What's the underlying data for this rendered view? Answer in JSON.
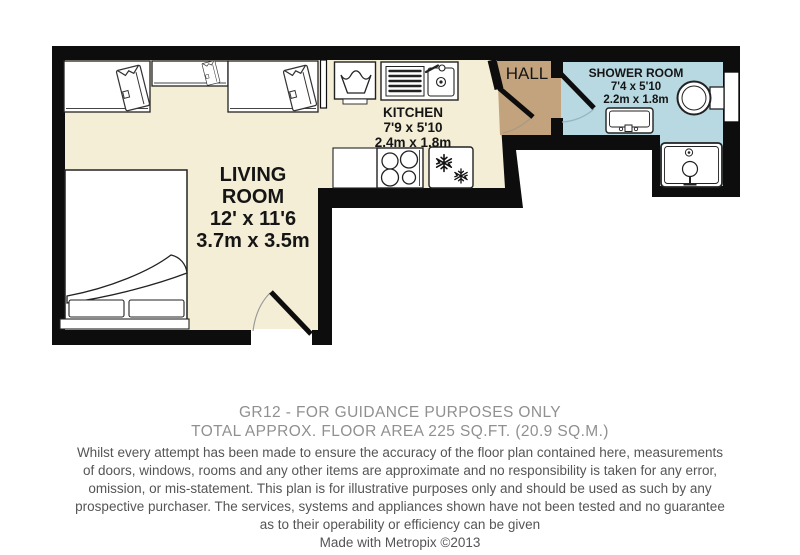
{
  "floorplan": {
    "living_room": {
      "label_line1": "LIVING",
      "label_line2": "ROOM",
      "size_imperial": "12' x 11'6",
      "size_metric": "3.7m x 3.5m"
    },
    "kitchen": {
      "label": "KITCHEN",
      "size_imperial": "7'9 x 5'10",
      "size_metric": "2.4m x 1.8m"
    },
    "hall": {
      "label": "HALL"
    },
    "shower_room": {
      "label": "SHOWER ROOM",
      "size_imperial": "7'4 x 5'10",
      "size_metric": "2.2m x 1.8m"
    },
    "colors": {
      "walls": "#0d0d0d",
      "floor": "#f4eed6",
      "hall_floor": "#c2a37d",
      "shower_floor": "#b8d8e2",
      "fixture_fill": "#ffffff"
    }
  },
  "caption": {
    "title_line1": "GR12 - FOR GUIDANCE PURPOSES ONLY",
    "title_line2": "TOTAL APPROX. FLOOR AREA 225 SQ.FT. (20.9 SQ.M.)",
    "disclaimer_lines": [
      "Whilst every attempt has been made to ensure the accuracy of the floor plan contained here, measurements",
      "of doors, windows, rooms and any other items are approximate and no responsibility is taken for any error,",
      "omission, or mis-statement. This plan is for illustrative purposes only and should be used as such by any",
      "prospective purchaser. The services, systems and appliances shown have not been tested and no guarantee",
      "as to their operability or efficiency can be given"
    ],
    "credit": "Made with Metropix ©2013"
  }
}
